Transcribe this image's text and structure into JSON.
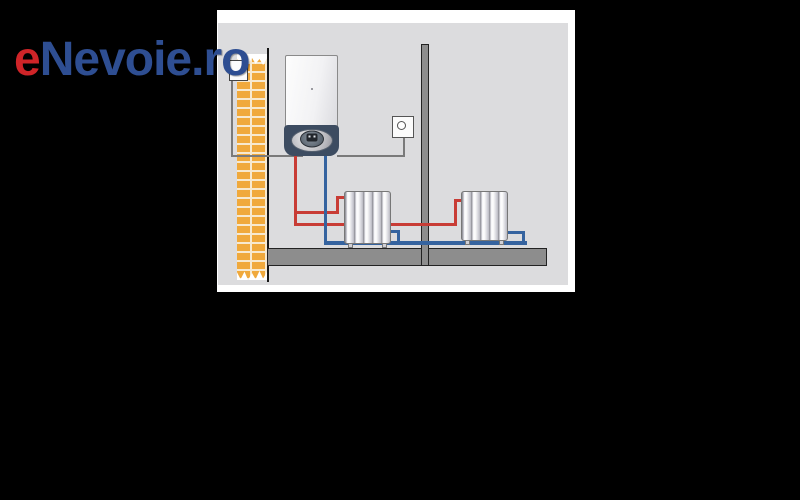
{
  "logo": {
    "text": "eNevoie.ro",
    "prefix": "e",
    "suffix": "Nevoie.ro",
    "colors": {
      "prefix_red": "#cf2428",
      "suffix_blue": "#2e4e92"
    }
  },
  "scene": {
    "subject": "central-heating-installation-diagram",
    "colors": {
      "page_background": "#000000",
      "photo_canvas": "#ffffff",
      "diagram_background": "#dcdcde",
      "brick_orange": "#f0a93c",
      "supply_pipe_red": "#c83c35",
      "return_pipe_blue": "#35639f",
      "boiler_base_slate": "#3d4c61",
      "structure_gray": "#8d8d8d",
      "cable_gray": "#7a7a7a"
    },
    "components": [
      "wall-mounted-boiler",
      "circulation-pump",
      "room-thermostat",
      "radiator-left",
      "radiator-right",
      "supply-pipe-red",
      "return-pipe-blue",
      "brick-wall",
      "partition-wall",
      "floor-slab",
      "wall-outlet",
      "thermostat-cable"
    ]
  }
}
